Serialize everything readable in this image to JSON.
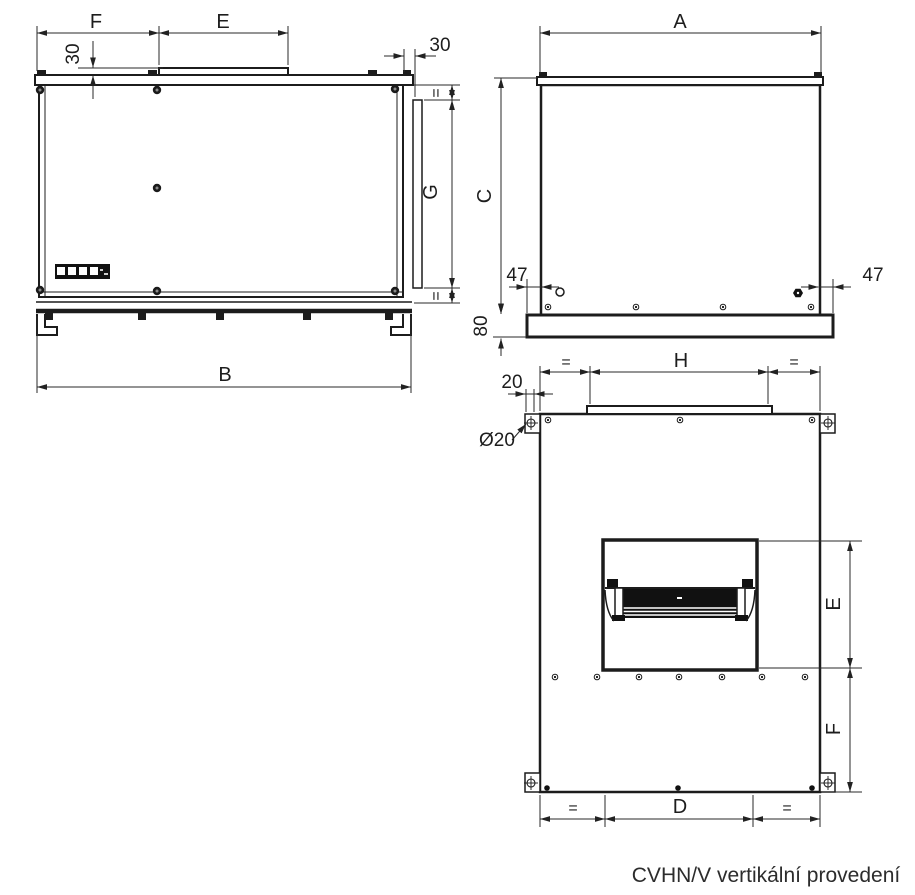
{
  "caption": "CVHN/V vertikální provedení",
  "side_view": {
    "dim_F": "F",
    "dim_E": "E",
    "dim_collar_height": "30",
    "dim_flange_offset": "30",
    "dim_eq_top": "=",
    "dim_G": "G",
    "dim_eq_bottom": "=",
    "dim_B": "B"
  },
  "front_view": {
    "dim_A": "A",
    "dim_C": "C",
    "dim_47_left": "47",
    "dim_47_right": "47",
    "dim_base_height": "80"
  },
  "vertical_view": {
    "dim_eq_top_left": "=",
    "dim_H": "H",
    "dim_eq_top_right": "=",
    "dim_20": "20",
    "hole_diameter": "Ø20",
    "dim_E": "E",
    "dim_F": "F",
    "dim_eq_bottom_left": "=",
    "dim_D": "D",
    "dim_eq_bottom_right": "="
  }
}
